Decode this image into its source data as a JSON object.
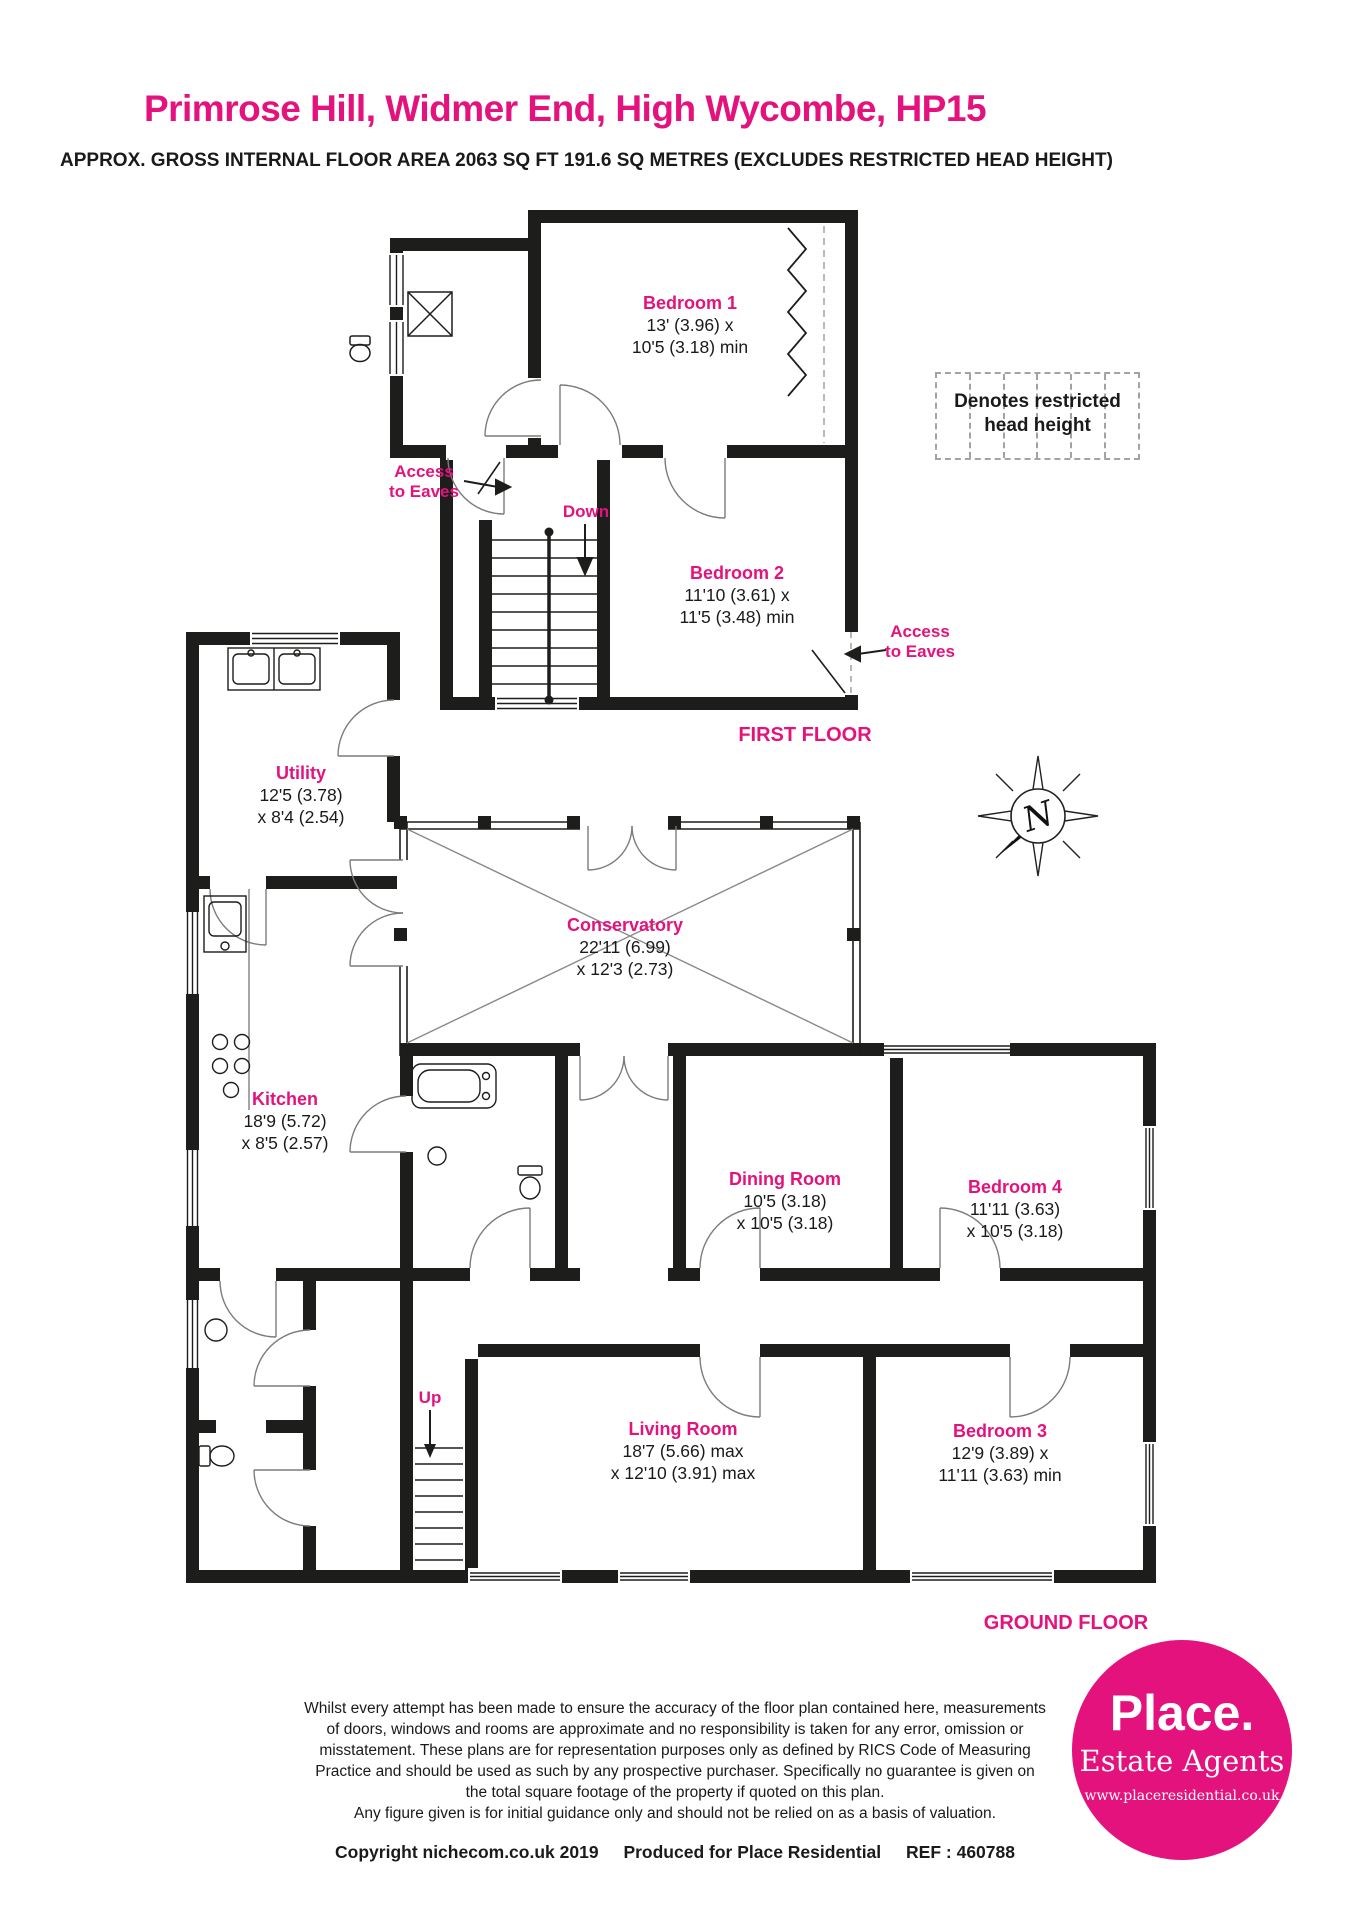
{
  "header": {
    "title": "Primrose Hill, Widmer End, High Wycombe, HP15",
    "subtitle": "APPROX. GROSS INTERNAL FLOOR AREA 2063 SQ FT 191.6 SQ METRES (EXCLUDES RESTRICTED HEAD HEIGHT)"
  },
  "legend": {
    "line1": "Denotes restricted",
    "line2": "head height"
  },
  "compass": {
    "north_label": "N"
  },
  "annotations": {
    "access_line1": "Access",
    "access_line2": "to Eaves",
    "down": "Down",
    "up": "Up"
  },
  "first_floor": {
    "label": "FIRST FLOOR",
    "rooms": [
      {
        "name": "Bedroom 1",
        "dim1": "13' (3.96) x",
        "dim2": "10'5 (3.18) min"
      },
      {
        "name": "Bedroom 2",
        "dim1": "11'10 (3.61) x",
        "dim2": "11'5 (3.48) min"
      }
    ]
  },
  "ground_floor": {
    "label": "GROUND FLOOR",
    "rooms": [
      {
        "name": "Utility",
        "dim1": "12'5 (3.78)",
        "dim2": "x 8'4 (2.54)"
      },
      {
        "name": "Conservatory",
        "dim1": "22'11 (6.99)",
        "dim2": "x 12'3 (2.73)"
      },
      {
        "name": "Kitchen",
        "dim1": "18'9 (5.72)",
        "dim2": "x 8'5 (2.57)"
      },
      {
        "name": "Dining Room",
        "dim1": "10'5 (3.18)",
        "dim2": "x 10'5 (3.18)"
      },
      {
        "name": "Bedroom 4",
        "dim1": "11'11 (3.63)",
        "dim2": "x 10'5 (3.18)"
      },
      {
        "name": "Living Room",
        "dim1": "18'7 (5.66) max",
        "dim2": "x 12'10 (3.91) max"
      },
      {
        "name": "Bedroom 3",
        "dim1": "12'9 (3.89) x",
        "dim2": "11'11 (3.63) min"
      }
    ]
  },
  "footer": {
    "disclaimer": [
      "Whilst every attempt has been made to ensure the accuracy of the floor plan contained here, measurements",
      "of doors, windows and rooms are approximate and no responsibility is taken for any error, omission or",
      "misstatement. These plans are for representation purposes only as defined by RICS Code of Measuring",
      "Practice and should be used as such by any prospective purchaser.  Specifically no guarantee is given on",
      "the total square footage of the property if quoted on this plan.",
      "Any figure given is for initial guidance only and should not be relied on as a basis of valuation."
    ],
    "copyright_left": "Copyright nichecom.co.uk 2019",
    "copyright_mid": "Produced for Place Residential",
    "copyright_ref": "REF : 460788"
  },
  "logo": {
    "brand": "Place.",
    "tagline": "Estate Agents",
    "website": "www.placeresidential.co.uk"
  },
  "colors": {
    "accent": "#E4127D",
    "wall": "#1D1D1B"
  }
}
